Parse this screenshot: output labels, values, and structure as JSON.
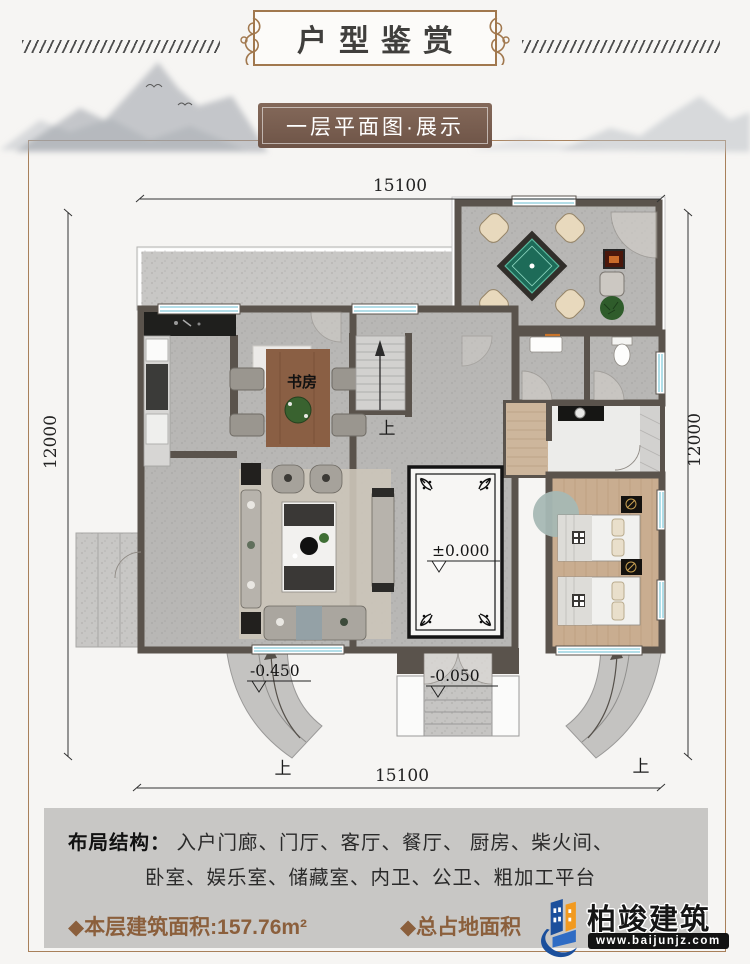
{
  "page": {
    "title": "户型鉴赏",
    "subtitle": "一层平面图·展示"
  },
  "plan": {
    "dim_top": "15100",
    "dim_bottom": "15100",
    "dim_left": "12000",
    "dim_right": "12000",
    "study_label": "书房",
    "elevation_zero": "±0.000",
    "elevation_ramp": "-0.450",
    "elevation_porch": "-0.050",
    "up_stairs": "上",
    "up_ramp_left": "上",
    "up_ramp_right": "上"
  },
  "footer": {
    "layout_label": "布局结构：",
    "layout_line1": "入户门廊、门厅、客厅、餐厅、 厨房、柴火间、",
    "layout_line2": "卧室、娱乐室、储藏室、内卫、公卫、粗加工平台",
    "area_floor": "◆本层建筑面积:157.76m²",
    "area_total": "◆总占地面积"
  },
  "logo": {
    "name": "柏竣建筑",
    "url": "www.baijunjz.com"
  },
  "colors": {
    "accent_brown": "#8b5f3c",
    "banner_brown": "#7b6152",
    "wall": "#5a534c",
    "window_cyan": "#86cbdb",
    "logo_blue": "#1b4f9c",
    "logo_orange": "#f29a1f"
  }
}
